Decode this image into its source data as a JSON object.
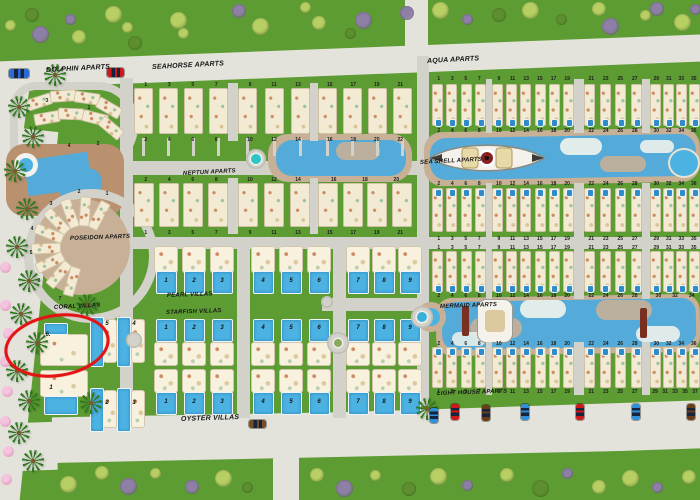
{
  "map_title": "resort site plan",
  "colors": {
    "grass": "#5d9c33",
    "road_main": "#e3e3dc",
    "road_inner": "#d2d2ca",
    "deck": "#c7b096",
    "deck_warm": "#b9916f",
    "water": "#54abd9",
    "pool": "#4cb2e2",
    "building": "#f2ead2",
    "villa": "#f7f1de",
    "annotation_red": "#e21414",
    "bush_light": "#b8cf63",
    "bush_purple": "#8e7fa6",
    "bush_dark": "#5d8f2e"
  },
  "labels": [
    {
      "id": "dolphin",
      "text": "DOLPHIN APARTS",
      "x": 46,
      "y": 67,
      "rot": -3,
      "fs": 7
    },
    {
      "id": "seahorse",
      "text": "SEAHORSE APARTS",
      "x": 152,
      "y": 64,
      "rot": -3,
      "fs": 7
    },
    {
      "id": "aqua",
      "text": "AQUA APARTS",
      "x": 427,
      "y": 58,
      "rot": -3,
      "fs": 7
    },
    {
      "id": "neptun",
      "text": "NEPTUN APARTS",
      "x": 183,
      "y": 171,
      "rot": -3,
      "fs": 6
    },
    {
      "id": "seashell",
      "text": "SEA SHELL APARTS 7",
      "x": 420,
      "y": 160,
      "rot": -3,
      "fs": 6
    },
    {
      "id": "poseidon",
      "text": "POSEIDON APARTS",
      "x": 70,
      "y": 236,
      "rot": -2,
      "fs": 6
    },
    {
      "id": "pearl",
      "text": "PEARL VILLAS",
      "x": 167,
      "y": 293,
      "rot": -2,
      "fs": 6
    },
    {
      "id": "coral",
      "text": "CORAL VILLAS",
      "x": 54,
      "y": 305,
      "rot": -3,
      "fs": 6
    },
    {
      "id": "starfish",
      "text": "STARFISH VILLAS",
      "x": 166,
      "y": 310,
      "rot": -2,
      "fs": 6
    },
    {
      "id": "mermaid",
      "text": "MERMAID APARTS",
      "x": 440,
      "y": 304,
      "rot": -2,
      "fs": 6
    },
    {
      "id": "lighthouse",
      "text": "LIGHT HOUSE APARTS",
      "x": 437,
      "y": 391,
      "rot": -2,
      "fs": 6
    },
    {
      "id": "oyster",
      "text": "OYSTER VILLAS",
      "x": 181,
      "y": 416,
      "rot": -2,
      "fs": 7
    }
  ],
  "apartment_bands": [
    {
      "id": "seahorse-block",
      "y": 88,
      "h": 46,
      "unit_w": 19,
      "num_top_y": 82,
      "num_bot_y": 137,
      "pool_side": "",
      "walks": true,
      "clusters": [
        {
          "x": 134,
          "w": 94,
          "units": 4,
          "top": "1 3 5 7",
          "bottom": "2 4 6 8"
        },
        {
          "x": 238,
          "w": 72,
          "units": 3,
          "top": "9 11 13",
          "bottom": "10 12 14"
        },
        {
          "x": 318,
          "w": 94,
          "units": 4,
          "top": "15 17 19 21",
          "bottom": "16 18 20 22"
        }
      ]
    },
    {
      "id": "aqua",
      "y": 84,
      "h": 42,
      "unit_w": 11,
      "num_top_y": 76,
      "num_bot_y": 128,
      "pool_side": "s",
      "clusters": [
        {
          "x": 432,
          "w": 54,
          "units": 4,
          "top": "1 3 5 7",
          "bottom": "2 4 6 8"
        },
        {
          "x": 492,
          "w": 82,
          "units": 6,
          "top": "9 11 13 15 17 19",
          "bottom": "10 12 14 16 18 20"
        },
        {
          "x": 584,
          "w": 58,
          "units": 4,
          "top": "21 23 25 27",
          "bottom": "22 24 26 28"
        },
        {
          "x": 650,
          "w": 50,
          "units": 4,
          "top": "29 31 33 35",
          "bottom": "30 32 34 36"
        }
      ]
    },
    {
      "id": "seashell-south",
      "y": 188,
      "h": 44,
      "unit_w": 11,
      "num_top_y": 181,
      "num_bot_y": 236,
      "pool_side": "n",
      "clusters": [
        {
          "x": 432,
          "w": 54,
          "units": 4,
          "top": "2 4 6 8",
          "bottom": "1 3 5 7"
        },
        {
          "x": 492,
          "w": 82,
          "units": 6,
          "top": "10 12 14 16 18 20",
          "bottom": "9 11 13 15 17 19"
        },
        {
          "x": 584,
          "w": 58,
          "units": 4,
          "top": "22 24 26 28",
          "bottom": "21 23 25 27"
        },
        {
          "x": 650,
          "w": 50,
          "units": 4,
          "top": "30 32 34 36",
          "bottom": "29 31 33 35"
        }
      ]
    },
    {
      "id": "mermaid-north",
      "y": 251,
      "h": 41,
      "unit_w": 11,
      "num_top_y": 245,
      "num_bot_y": 293,
      "pool_side": "s",
      "clusters": [
        {
          "x": 432,
          "w": 54,
          "units": 4,
          "top": "1 3 5 7",
          "bottom": "2 4 6 8"
        },
        {
          "x": 492,
          "w": 82,
          "units": 6,
          "top": "9 11 13 15 17 19",
          "bottom": "10 12 14 16 18 20"
        },
        {
          "x": 584,
          "w": 58,
          "units": 4,
          "top": "21 23 25 27",
          "bottom": "22 24 26 28"
        },
        {
          "x": 650,
          "w": 50,
          "units": 4,
          "top": "29 31 33 35",
          "bottom": "30 32 34"
        }
      ]
    },
    {
      "id": "lighthouse",
      "y": 347,
      "h": 41,
      "unit_w": 11,
      "num_top_y": 341,
      "num_bot_y": 389,
      "pool_side": "n",
      "clusters": [
        {
          "x": 432,
          "w": 54,
          "units": 4,
          "top": "2 4 6 8",
          "bottom": "1 3 5 7"
        },
        {
          "x": 492,
          "w": 82,
          "units": 6,
          "top": "10 12 14 16 18 20",
          "bottom": "9 11 13 15 17 19"
        },
        {
          "x": 584,
          "w": 58,
          "units": 4,
          "top": "22 24 26 28",
          "bottom": "21 23 25 27"
        },
        {
          "x": 650,
          "w": 50,
          "units": 4,
          "top": "30 32 34 36",
          "bottom": "29 31 33 35 37"
        }
      ]
    },
    {
      "id": "neptun",
      "y": 183,
      "h": 44,
      "unit_w": 20,
      "num_top_y": 177,
      "num_bot_y": 230,
      "pool_side": "",
      "clusters": [
        {
          "x": 134,
          "w": 94,
          "units": 4,
          "top": "2 4 6 8",
          "bottom": "1 3 5 7"
        },
        {
          "x": 238,
          "w": 72,
          "units": 3,
          "top": "10 12 14",
          "bottom": "9 11 13"
        },
        {
          "x": 318,
          "w": 94,
          "units": 4,
          "top": "16 18 20",
          "bottom": "15 17 19 21"
        }
      ]
    }
  ],
  "villa_rows": [
    {
      "id": "pearl-villas",
      "body_y": 246,
      "body_h": 27,
      "pool_y": 271,
      "pool_h": 21,
      "num_y": 278,
      "x": [
        154,
        182,
        210,
        251,
        279,
        307,
        346,
        372,
        398
      ],
      "numbers": [
        "1",
        "2",
        "3",
        "4",
        "5",
        "6",
        "7",
        "8",
        "9"
      ]
    },
    {
      "id": "starfish-villas",
      "body_y": 342,
      "body_h": 24,
      "pool_y": 319,
      "pool_h": 21,
      "num_y": 325,
      "x": [
        154,
        182,
        210,
        251,
        279,
        307,
        346,
        372,
        398
      ],
      "numbers": [
        "1",
        "2",
        "3",
        "4",
        "5",
        "6",
        "7",
        "8",
        "9"
      ]
    },
    {
      "id": "oyster-villas",
      "body_y": 369,
      "body_h": 24,
      "pool_y": 392,
      "pool_h": 21,
      "num_y": 399,
      "x": [
        154,
        182,
        210,
        251,
        279,
        307,
        346,
        372,
        398
      ],
      "numbers": [
        "1",
        "2",
        "3",
        "4",
        "5",
        "6",
        "7",
        "8",
        "9"
      ]
    }
  ],
  "coral_villas": [
    {
      "n": "6.",
      "house": [
        40,
        334,
        48,
        32
      ],
      "pool": [
        44,
        323,
        22,
        10
      ],
      "num": [
        42,
        332
      ]
    },
    {
      "n": "1",
      "house": [
        40,
        370,
        48,
        27
      ],
      "pool": [
        44,
        396,
        32,
        17
      ],
      "num": [
        45,
        385
      ]
    },
    {
      "n": "5",
      "pool": [
        90,
        317,
        12,
        48
      ],
      "house": [
        103,
        319,
        14,
        44
      ],
      "num": [
        101,
        321
      ]
    },
    {
      "n": "4",
      "pool": [
        117,
        317,
        12,
        48
      ],
      "house": [
        131,
        319,
        14,
        44
      ],
      "num": [
        128,
        321
      ]
    },
    {
      "n": "2",
      "pool": [
        90,
        388,
        12,
        42
      ],
      "house": [
        103,
        390,
        14,
        38
      ],
      "num": [
        101,
        400
      ]
    },
    {
      "n": "3",
      "pool": [
        117,
        388,
        12,
        42
      ],
      "house": [
        131,
        390,
        14,
        38
      ],
      "num": [
        128,
        400
      ]
    }
  ],
  "poseidon_numbers": [
    {
      "t": "1",
      "x": 102,
      "y": 191
    },
    {
      "t": "2",
      "x": 74,
      "y": 189
    },
    {
      "t": "3",
      "x": 46,
      "y": 201
    },
    {
      "t": "4",
      "x": 27,
      "y": 226
    },
    {
      "t": "5",
      "x": 26,
      "y": 250
    },
    {
      "t": "6",
      "x": 34,
      "y": 278
    },
    {
      "t": "7",
      "x": 55,
      "y": 296
    }
  ],
  "dolphin_numbers": [
    {
      "t": "1",
      "x": 84,
      "y": 105
    },
    {
      "t": "2",
      "x": 93,
      "y": 141
    },
    {
      "t": "3",
      "x": 42,
      "y": 98
    },
    {
      "t": "4",
      "x": 64,
      "y": 143
    },
    {
      "t": "5",
      "x": 29,
      "y": 133
    }
  ],
  "vehicles": [
    {
      "kind": "bus",
      "color": "#2b6bd8",
      "x": 9,
      "y": 69,
      "w": 20,
      "h": 9,
      "vert": false
    },
    {
      "kind": "car",
      "color": "#d01818",
      "x": 107,
      "y": 68,
      "w": 17,
      "h": 9,
      "vert": false
    },
    {
      "kind": "car",
      "color": "#7a4a22",
      "x": 249,
      "y": 420,
      "w": 17,
      "h": 8,
      "vert": false
    },
    {
      "kind": "car",
      "color": "#2f8fd8",
      "x": 430,
      "y": 408,
      "w": 8,
      "h": 15,
      "vert": true
    },
    {
      "kind": "car",
      "color": "#d01818",
      "x": 451,
      "y": 404,
      "w": 8,
      "h": 16,
      "vert": true
    },
    {
      "kind": "car",
      "color": "#6b3d16",
      "x": 482,
      "y": 405,
      "w": 8,
      "h": 16,
      "vert": true
    },
    {
      "kind": "car",
      "color": "#2f8fd8",
      "x": 521,
      "y": 404,
      "w": 8,
      "h": 16,
      "vert": true
    },
    {
      "kind": "car",
      "color": "#d01818",
      "x": 576,
      "y": 404,
      "w": 8,
      "h": 16,
      "vert": true
    },
    {
      "kind": "car",
      "color": "#2f8fd8",
      "x": 632,
      "y": 404,
      "w": 8,
      "h": 16,
      "vert": true
    },
    {
      "kind": "car",
      "color": "#6b3d16",
      "x": 687,
      "y": 404,
      "w": 8,
      "h": 16,
      "vert": true
    }
  ],
  "annotation": {
    "shape": "ellipse",
    "x": 4,
    "y": 314,
    "w": 100,
    "h": 57,
    "rot": -9,
    "stroke_w": 3.5
  }
}
